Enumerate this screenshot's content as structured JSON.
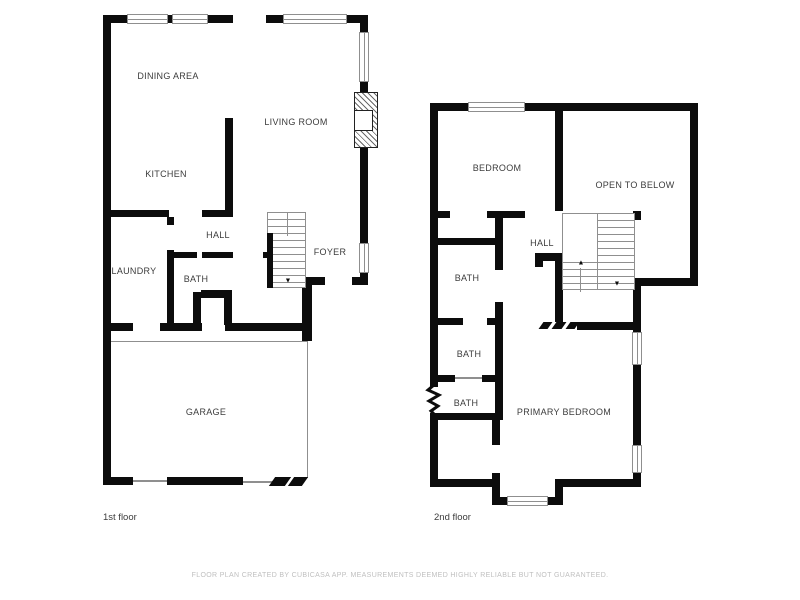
{
  "footer": {
    "disclaimer": "FLOOR PLAN CREATED BY CUBICASA APP. MEASUREMENTS DEEMED HIGHLY RELIABLE BUT NOT GUARANTEED."
  },
  "colors": {
    "wall": "#0c0c0c",
    "label_text": "#3c3c3c",
    "footer_text": "#bfbfbf",
    "thin_line": "#8f8f8f",
    "background": "#ffffff"
  },
  "floors": [
    {
      "caption": "1st floor",
      "rooms": [
        {
          "label": "DINING AREA"
        },
        {
          "label": "LIVING ROOM"
        },
        {
          "label": "KITCHEN"
        },
        {
          "label": "HALL"
        },
        {
          "label": "FOYER"
        },
        {
          "label": "LAUNDRY"
        },
        {
          "label": "BATH"
        },
        {
          "label": "GARAGE"
        }
      ],
      "stairs": {
        "down_arrow": "▼"
      }
    },
    {
      "caption": "2nd floor",
      "rooms": [
        {
          "label": "BEDROOM"
        },
        {
          "label": "OPEN TO BELOW"
        },
        {
          "label": "HALL"
        },
        {
          "label": "BATH"
        },
        {
          "label": "BATH"
        },
        {
          "label": "BATH"
        },
        {
          "label": "PRIMARY BEDROOM"
        }
      ],
      "stairs": {
        "up_arrow": "▲",
        "down_arrow": "▼"
      }
    }
  ]
}
